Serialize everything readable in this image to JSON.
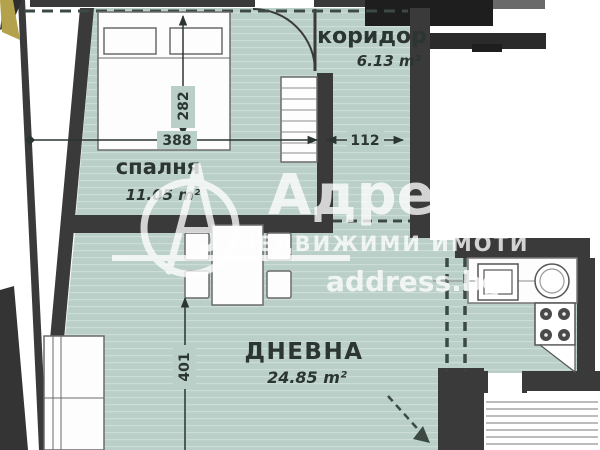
{
  "floorplan": {
    "rooms": {
      "corridor": {
        "label": "коридор",
        "area": "6.13 m²"
      },
      "bedroom": {
        "label": "спалня",
        "area": "11.05 m²"
      },
      "living": {
        "label": "ДНЕВНА",
        "area": "24.85 m²"
      }
    },
    "dimensions": {
      "bedroom_width": "388",
      "bedroom_depth": "282",
      "corridor_width": "112",
      "living_depth": "401"
    },
    "watermark": {
      "brand": "Адрес",
      "tagline": "НЕДВИЖИМИ ИМОТИ",
      "website": "address.bg"
    },
    "colors": {
      "floor": "#b9cfc7",
      "wall": "#3a3a3a",
      "wall_dark": "#1e1e1e",
      "ink": "#2b3531",
      "accent_yellow": "#b3a24b",
      "watermark": "#ffffff"
    }
  }
}
